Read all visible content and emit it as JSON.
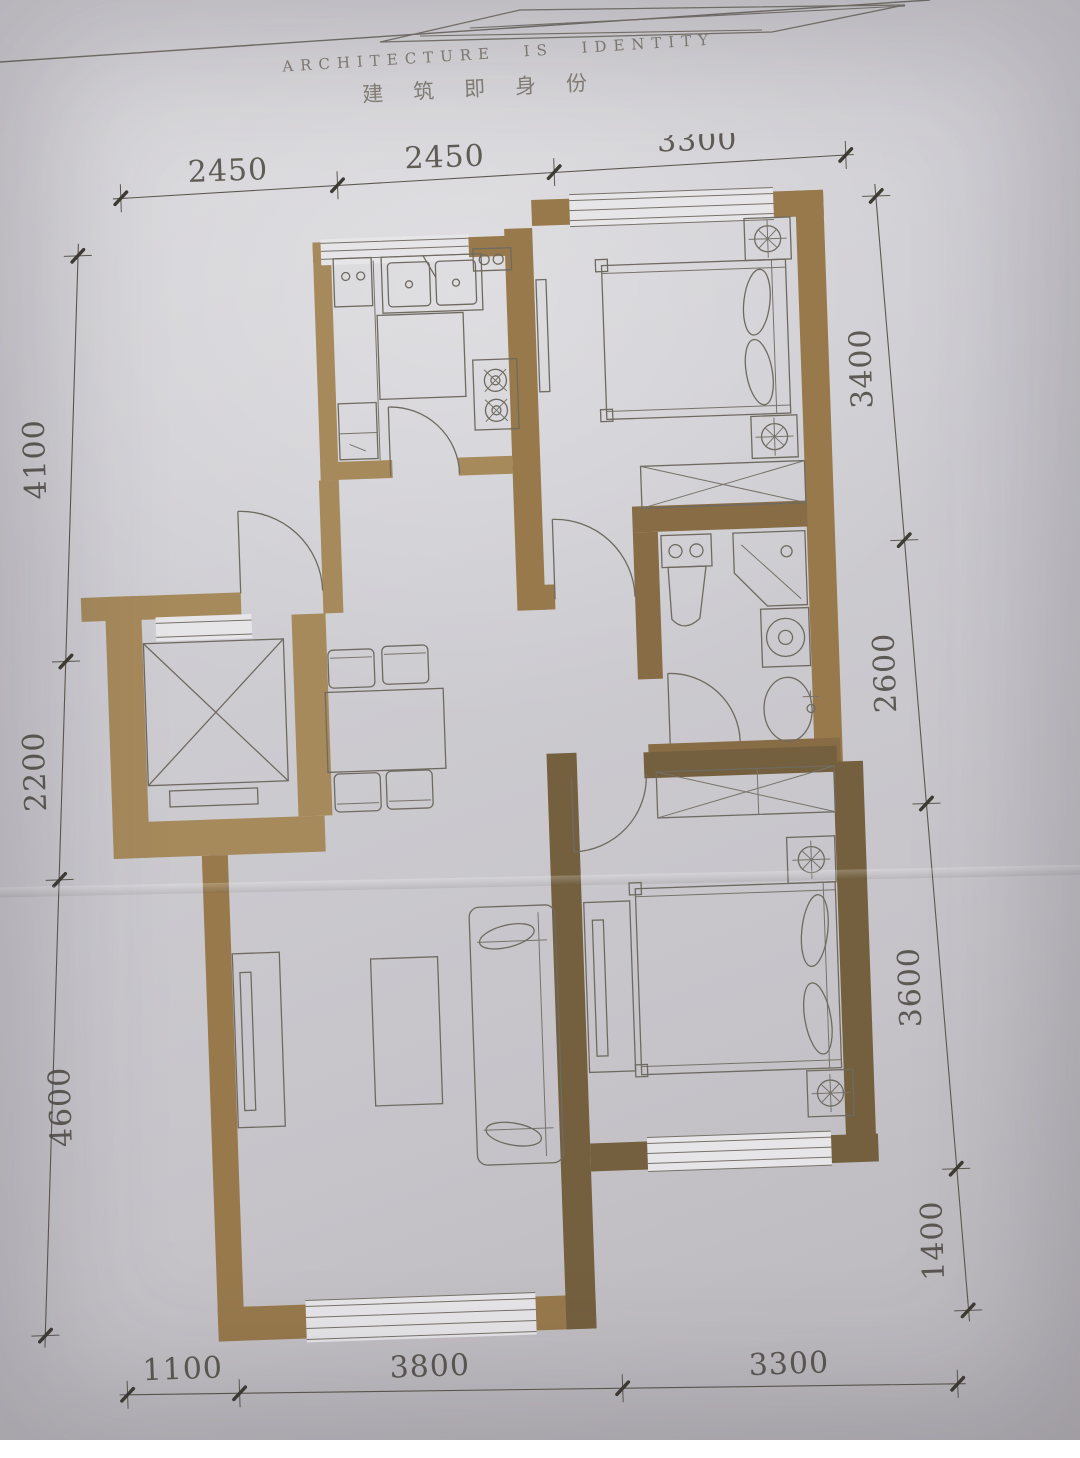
{
  "header": {
    "motto_en": "ARCHITECTURE IS IDENTITY",
    "motto_zh": "建筑即身份"
  },
  "dimensions": {
    "top": [
      "2450",
      "2450",
      "3300"
    ],
    "left": [
      "4100",
      "2200",
      "4600"
    ],
    "right": [
      "3400",
      "2600",
      "3600",
      "1400"
    ],
    "bottom": [
      "1100",
      "3800",
      "3300"
    ]
  },
  "colors": {
    "wall": "#97794c",
    "wall_light": "#a68a5c",
    "wall_dark": "#74603e",
    "furniture_line": "#6f6a61",
    "paper": "#cecdd2",
    "dimension_text": "#4f4a44"
  },
  "plan": {
    "type": "apartment-floor-plan",
    "fixtures": [
      "elevator",
      "double-bed",
      "nightstand-lamp",
      "wardrobe",
      "toilet",
      "shower",
      "washing-machine",
      "wash-basin",
      "double-kitchen-sink",
      "gas-stove",
      "dining-table",
      "dining-chair",
      "sofa",
      "tv-cabinet",
      "coffee-table"
    ]
  }
}
